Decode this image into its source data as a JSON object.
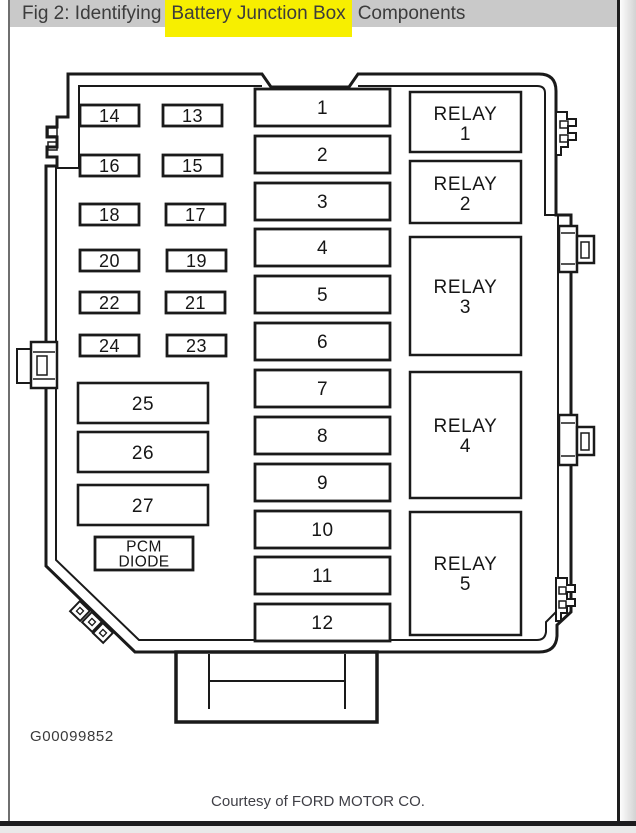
{
  "header": {
    "title_prefix": "Fig 2: Identifying",
    "title_highlight": "Battery Junction Box",
    "title_suffix": "Components",
    "bg_color": "#c9c9c9",
    "highlight_color": "#f7ef00"
  },
  "diagram": {
    "line_color": "#1a1a1a",
    "center_fuses": [
      "1",
      "2",
      "3",
      "4",
      "5",
      "6",
      "7",
      "8",
      "9",
      "10",
      "11",
      "12"
    ],
    "small_fuses_left": [
      "14",
      "16",
      "18",
      "20",
      "22",
      "24"
    ],
    "small_fuses_right": [
      "13",
      "15",
      "17",
      "19",
      "21",
      "23"
    ],
    "wide_fuses": [
      "25",
      "26",
      "27"
    ],
    "pcm_diode": {
      "line1": "PCM",
      "line2": "DIODE"
    },
    "relays": [
      {
        "label": "RELAY",
        "num": "1"
      },
      {
        "label": "RELAY",
        "num": "2"
      },
      {
        "label": "RELAY",
        "num": "3"
      },
      {
        "label": "RELAY",
        "num": "4"
      },
      {
        "label": "RELAY",
        "num": "5"
      }
    ],
    "figure_id": "G00099852"
  },
  "footer": {
    "credit": "Courtesy of FORD MOTOR CO."
  }
}
